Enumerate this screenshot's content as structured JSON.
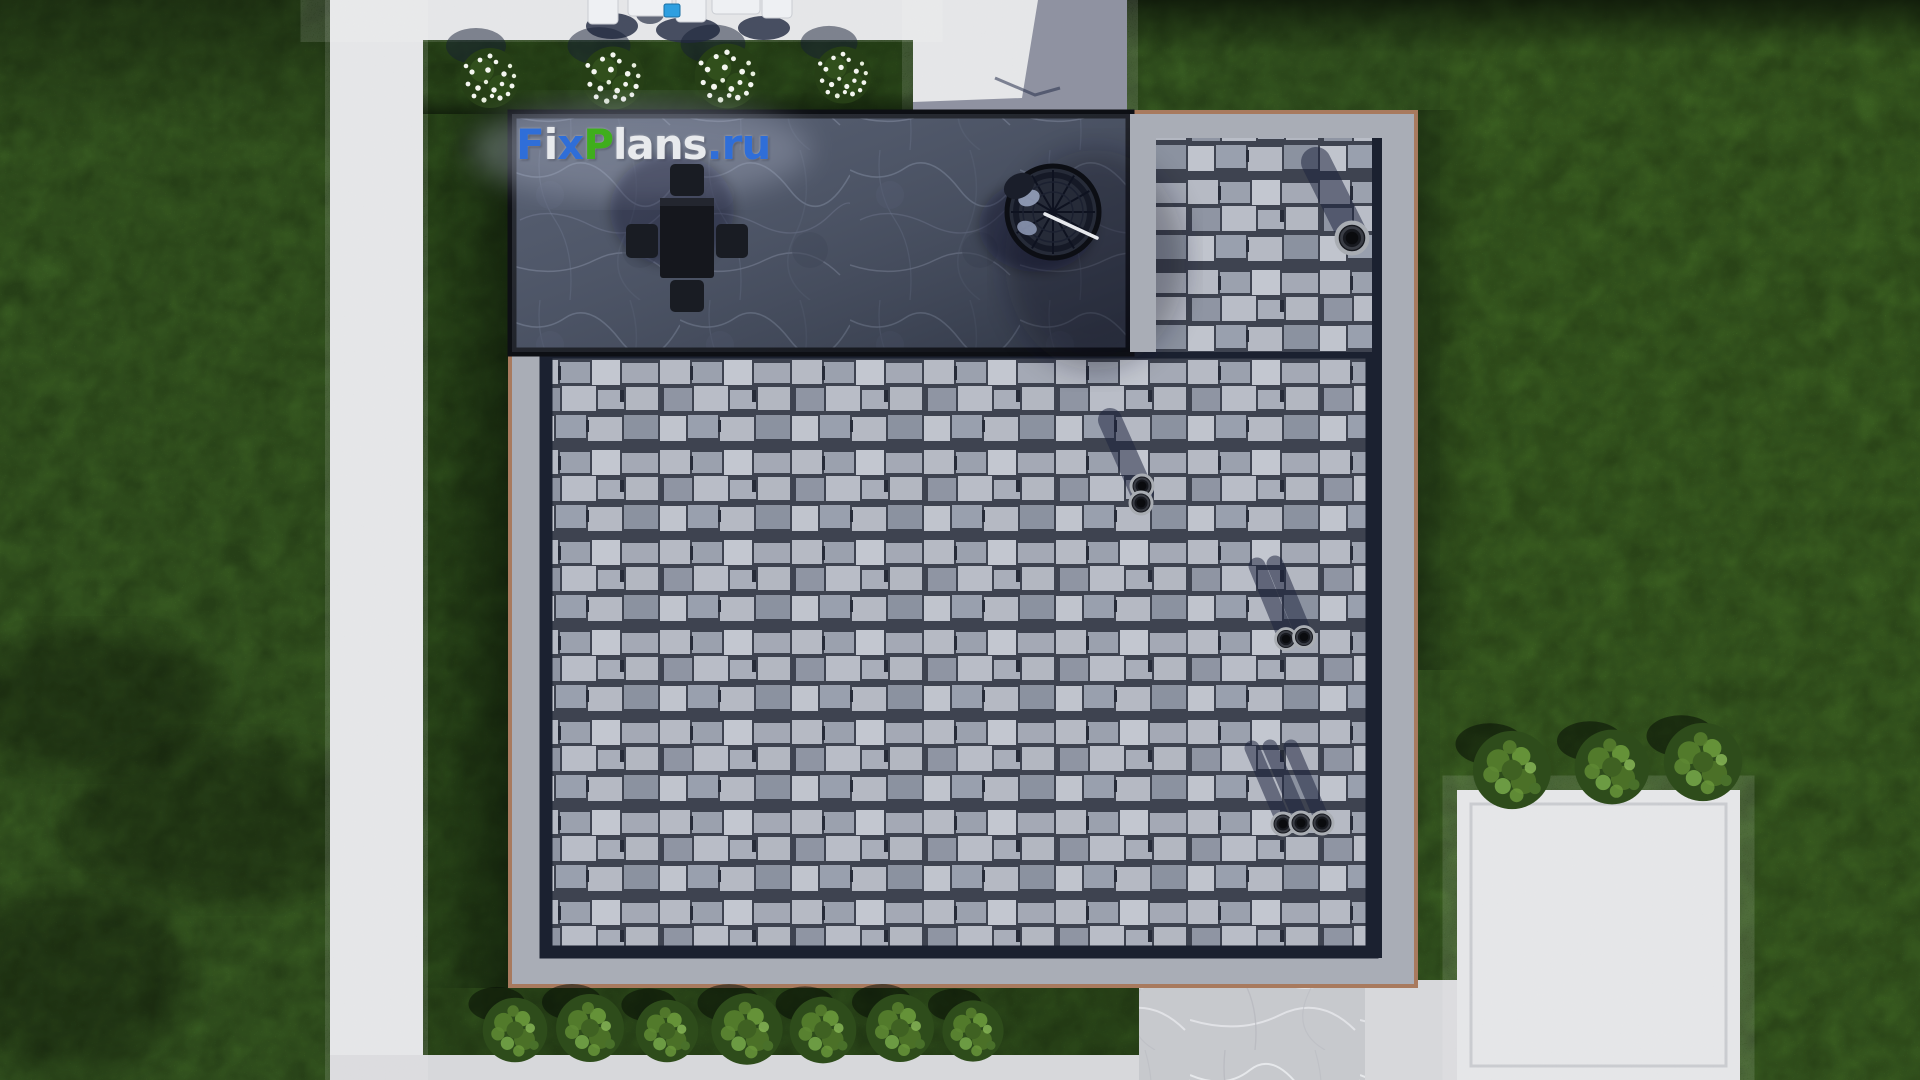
{
  "watermark": {
    "text": "FixPlans.ru",
    "letters": [
      {
        "ch": "F",
        "color": "#2f6ed8"
      },
      {
        "ch": "i",
        "color": "#e8eaed"
      },
      {
        "ch": "x",
        "color": "#2f6ed8"
      },
      {
        "ch": "P",
        "color": "#3fae1c"
      },
      {
        "ch": "l",
        "color": "#e8eaed"
      },
      {
        "ch": "a",
        "color": "#e8eaed"
      },
      {
        "ch": "n",
        "color": "#e8eaed"
      },
      {
        "ch": "s",
        "color": "#e8eaed"
      },
      {
        "ch": ".",
        "color": "#2f6ed8"
      },
      {
        "ch": "r",
        "color": "#2f6ed8"
      },
      {
        "ch": "u",
        "color": "#2f6ed8"
      }
    ]
  },
  "palette": {
    "grass": "#4f8130",
    "grass_bright": "#548830",
    "grass_dark": "#3f6a26",
    "grass_strip": "#426d27",
    "concrete": "#e2e3e5",
    "concrete_dim": "#d7d8db",
    "parapet": "#a9adb6",
    "channel": "#1b2130",
    "trim": "#a87a5e",
    "shingle_light": "#b6bac4",
    "shingle_dark": "#3e4350",
    "terrace_marble": "#424a5c",
    "furniture_dark": "#15171d",
    "accent_blue_item": "#2e9fe0",
    "flower_white": "#f4f6f0"
  },
  "scene_objects": {
    "building": "flat-roof-house-aerial-view",
    "terrace_items": [
      "dining-table-with-four-chairs",
      "hanging-egg-chair"
    ],
    "roof_vent_groups": 4,
    "flower_bush_count": 4,
    "bottom_bush_count": 7,
    "right_bush_count": 3
  },
  "vegetation": {
    "flower_bushes": [
      {
        "x": 490,
        "y": 78,
        "s": 1
      },
      {
        "x": 613,
        "y": 78,
        "s": 1.05
      },
      {
        "x": 727,
        "y": 76,
        "s": 1.08
      },
      {
        "x": 843,
        "y": 75,
        "s": 0.95
      }
    ],
    "bottom_bushes": [
      {
        "x": 515,
        "y": 1030,
        "s": 0.95
      },
      {
        "x": 590,
        "y": 1028,
        "s": 1.0
      },
      {
        "x": 667,
        "y": 1031,
        "s": 0.92
      },
      {
        "x": 747,
        "y": 1029,
        "s": 1.05
      },
      {
        "x": 823,
        "y": 1030,
        "s": 0.98
      },
      {
        "x": 900,
        "y": 1028,
        "s": 1.0
      },
      {
        "x": 973,
        "y": 1031,
        "s": 0.9
      }
    ],
    "right_bushes": [
      {
        "x": 1512,
        "y": 770,
        "s": 1.15
      },
      {
        "x": 1612,
        "y": 767,
        "s": 1.1
      },
      {
        "x": 1703,
        "y": 762,
        "s": 1.15
      }
    ]
  },
  "roof_vents": [
    {
      "shadow_width": 30,
      "shadows": [
        [
          1352,
          234,
          1316,
          162
        ]
      ],
      "pipes": [
        {
          "x": 1352,
          "y": 238,
          "s": 1.4
        }
      ]
    },
    {
      "shadow_width": 24,
      "shadows": [
        [
          1142,
          492,
          1110,
          420
        ]
      ],
      "pipes": [
        {
          "x": 1142,
          "y": 486,
          "s": 1.0
        },
        {
          "x": 1141,
          "y": 503,
          "s": 1.0
        }
      ]
    },
    {
      "shadow_width": 17,
      "shadows": [
        [
          1285,
          634,
          1257,
          566
        ],
        [
          1303,
          632,
          1275,
          564
        ]
      ],
      "pipes": [
        {
          "x": 1286,
          "y": 639,
          "s": 0.95
        },
        {
          "x": 1304,
          "y": 637,
          "s": 0.95
        }
      ]
    },
    {
      "shadow_width": 15,
      "shadows": [
        [
          1282,
          818,
          1252,
          748
        ],
        [
          1300,
          817,
          1270,
          747
        ],
        [
          1321,
          817,
          1291,
          747
        ]
      ],
      "pipes": [
        {
          "x": 1283,
          "y": 824,
          "s": 1.0
        },
        {
          "x": 1301,
          "y": 823,
          "s": 1.0
        },
        {
          "x": 1322,
          "y": 823,
          "s": 1.0
        }
      ]
    }
  ]
}
